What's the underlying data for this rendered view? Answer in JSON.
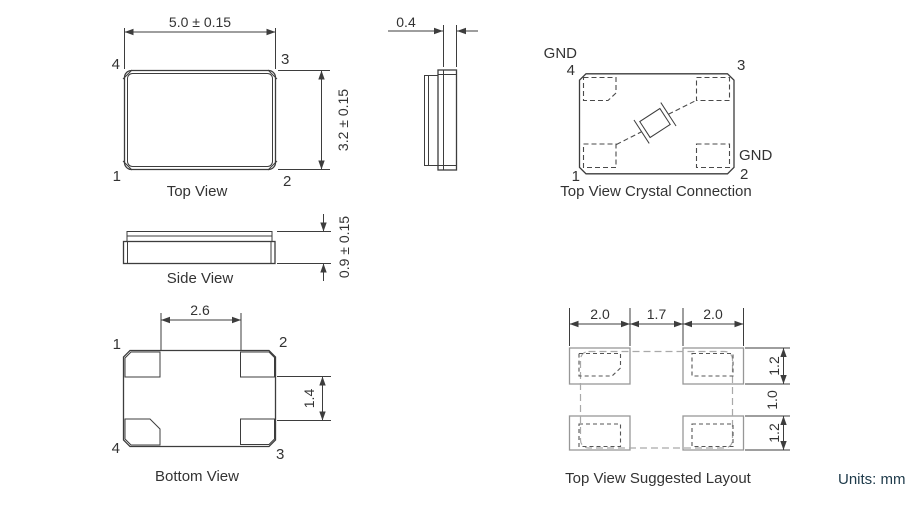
{
  "drawing": {
    "units_note": "Units: mm",
    "top_view": {
      "caption": "Top View",
      "width_dim": "5.0 ± 0.15",
      "height_dim": "3.2 ± 0.15",
      "pin_top_left": "4",
      "pin_top_right": "3",
      "pin_bottom_left": "1",
      "pin_bottom_right": "2"
    },
    "end_view": {
      "thickness_dim": "0.4"
    },
    "crystal_connection": {
      "caption": "Top View Crystal Connection",
      "gnd_label_top": "GND",
      "gnd_label_right": "GND",
      "pin_top_left": "4",
      "pin_top_right": "3",
      "pin_bottom_left": "1",
      "pin_bottom_right": "2"
    },
    "side_view": {
      "caption": "Side View",
      "height_dim": "0.9 ± 0.15"
    },
    "bottom_view": {
      "caption": "Bottom View",
      "pad_span_dim": "2.6",
      "pad_gap_dim": "1.4",
      "pin_top_left": "1",
      "pin_top_right": "2",
      "pin_bottom_left": "4",
      "pin_bottom_right": "3"
    },
    "suggested_layout": {
      "caption": "Top View Suggested Layout",
      "pad_width_left_dim": "2.0",
      "pad_gap_dim": "1.7",
      "pad_width_right_dim": "2.0",
      "pad_height_top_dim": "1.2",
      "row_gap_dim": "1.0",
      "pad_height_bottom_dim": "1.2"
    }
  }
}
